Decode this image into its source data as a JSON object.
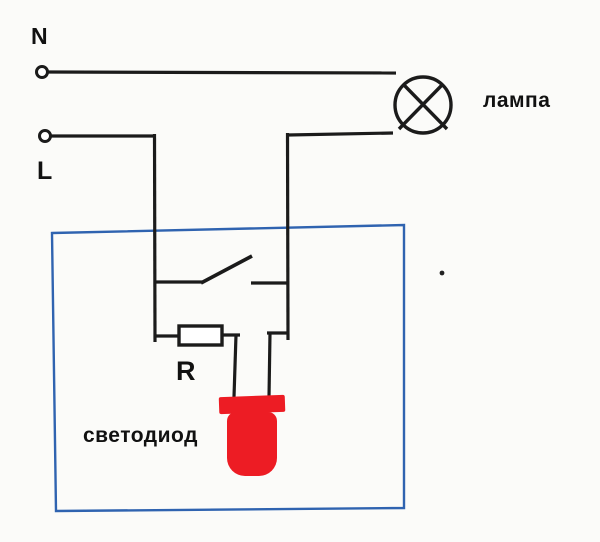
{
  "diagram": {
    "supply": {
      "neutral_label": "N",
      "line_label": "L"
    },
    "lamp_label": "лампа",
    "resistor_label": "R",
    "led_label": "светодиод",
    "colors": {
      "wire": "#1b1b1b",
      "enclosure": "#2f63b0",
      "led": "#ed1c24",
      "background": "#fbfbf9",
      "text": "#111111"
    }
  }
}
